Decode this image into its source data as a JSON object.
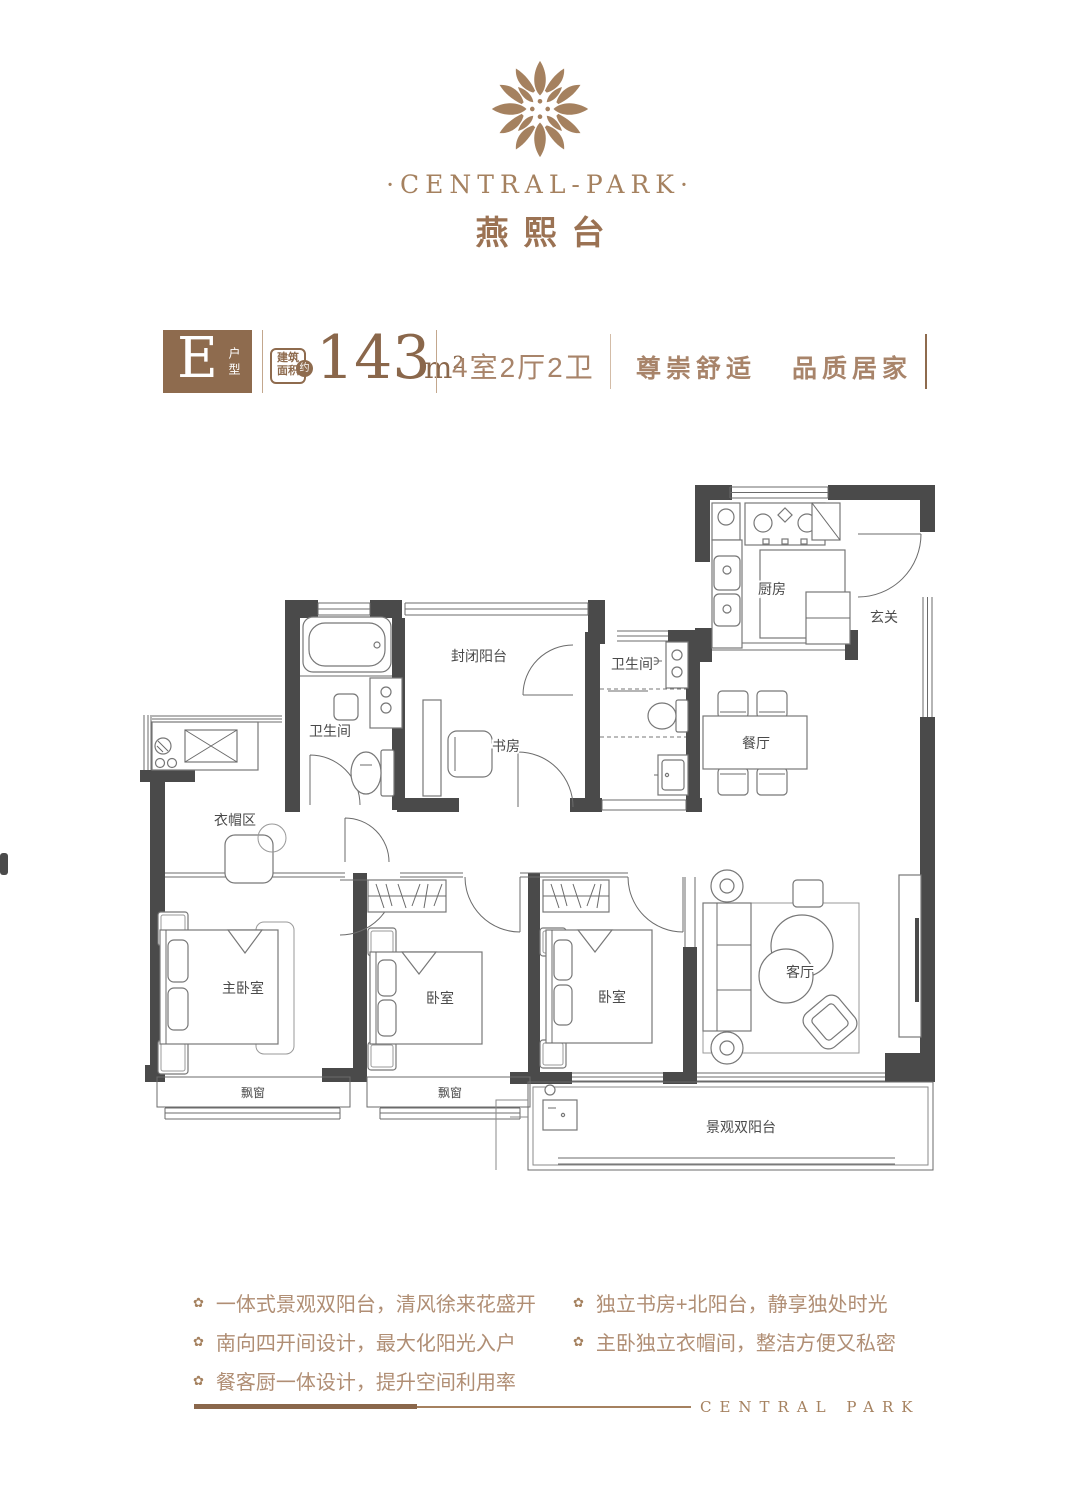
{
  "brand": {
    "logo_text": "·CENTRAL-PARK·",
    "project_name": "燕熙台",
    "footer_text": "CENTRAL PARK"
  },
  "spec": {
    "unit_type": "E",
    "unit_type_label": "户型",
    "area_label": "建筑面积",
    "area_approx": "约",
    "area_value": "143",
    "area_unit": "m²",
    "layout": "4室2厅2卫",
    "slogan_left": "尊崇舒适",
    "slogan_right": "品质居家",
    "accent_color": "#8e6b4e"
  },
  "floorplan": {
    "rooms": {
      "kitchen": "厨房",
      "entry": "玄关",
      "bath_a": "卫生间",
      "bath_b": "卫生间",
      "enclosed_balcony": "封闭阳台",
      "study": "书房",
      "dining": "餐厅",
      "cloakroom": "衣帽区",
      "master_bedroom": "主卧室",
      "bedroom_1": "卧室",
      "bedroom_2": "卧室",
      "living": "客厅",
      "bay_window_1": "飘窗",
      "bay_window_2": "飘窗",
      "view_balcony": "景观双阳台"
    }
  },
  "features": {
    "bullet": "✿",
    "col1": [
      "一体式景观双阳台，清风徐来花盛开",
      "南向四开间设计，最大化阳光入户",
      "餐客厨一体设计，提升空间利用率"
    ],
    "col2": [
      "独立书房+北阳台，静享独处时光",
      "主卧独立衣帽间，整洁方便又私密"
    ]
  }
}
